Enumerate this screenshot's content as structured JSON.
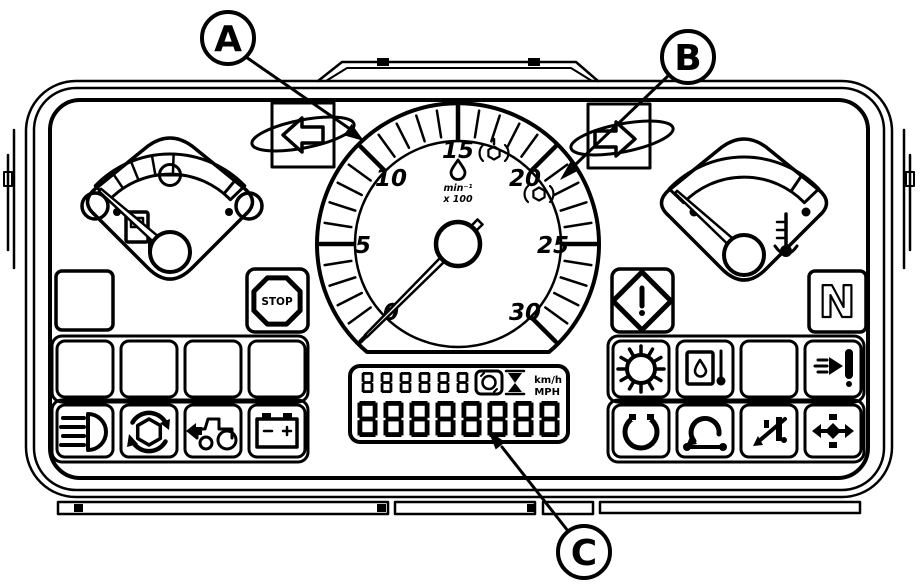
{
  "diagram": {
    "title": "tractor-instrument-cluster-diagram",
    "background_color": "#ffffff",
    "line_color": "#000000"
  },
  "callouts": {
    "a": {
      "label": "A"
    },
    "b": {
      "label": "B"
    },
    "c": {
      "label": "C"
    }
  },
  "tachometer": {
    "numbers": [
      "0",
      "5",
      "10",
      "15",
      "20",
      "25",
      "30"
    ],
    "min": 0,
    "max": 30,
    "needle_value": 0,
    "unit_line1": "min⁻¹",
    "unit_line2": "x 100",
    "icons": [
      "droplet-icon",
      "pto-540-icon",
      "pto-540e-icon"
    ]
  },
  "gauges": {
    "left": {
      "name": "fuel-gauge",
      "icons": [
        "circle-minus-icon",
        "fuel-pump-icon"
      ]
    },
    "right": {
      "name": "coolant-temperature-gauge",
      "icons": [
        "thermometer-icon"
      ]
    }
  },
  "turn_signals": {
    "left": "left-turn-arrow-icon",
    "right": "right-turn-arrow-icon"
  },
  "indicators": {
    "stop_label": "STOP",
    "neutral_label": "N",
    "left_panel": {
      "top_row": [
        "blank-square",
        "stop-octagon"
      ],
      "middle_row": [
        "blank",
        "blank",
        "blank",
        "blank"
      ],
      "bottom_row": [
        "headlight-icon",
        "pto-rotation-icon",
        "tractor-arrow-icon",
        "battery-icon"
      ]
    },
    "right_panel": {
      "top_row": [
        "warning-diamond-icon",
        "neutral-indicator"
      ],
      "middle_row": [
        "glow-plug-icon",
        "oil-temperature-icon",
        "blank",
        "hitch-arrow-icon"
      ],
      "bottom_row": [
        "pto-shaft-icon",
        "axle-rotation-icon",
        "wheel-drive-icon",
        "differential-lock-icon"
      ]
    }
  },
  "lcd": {
    "top_digits": "888888",
    "bottom_digits": "88888888",
    "unit_top": "km/h",
    "unit_bottom": "MPH",
    "icons": [
      "pto-speed-icon",
      "hourglass-icon"
    ]
  }
}
